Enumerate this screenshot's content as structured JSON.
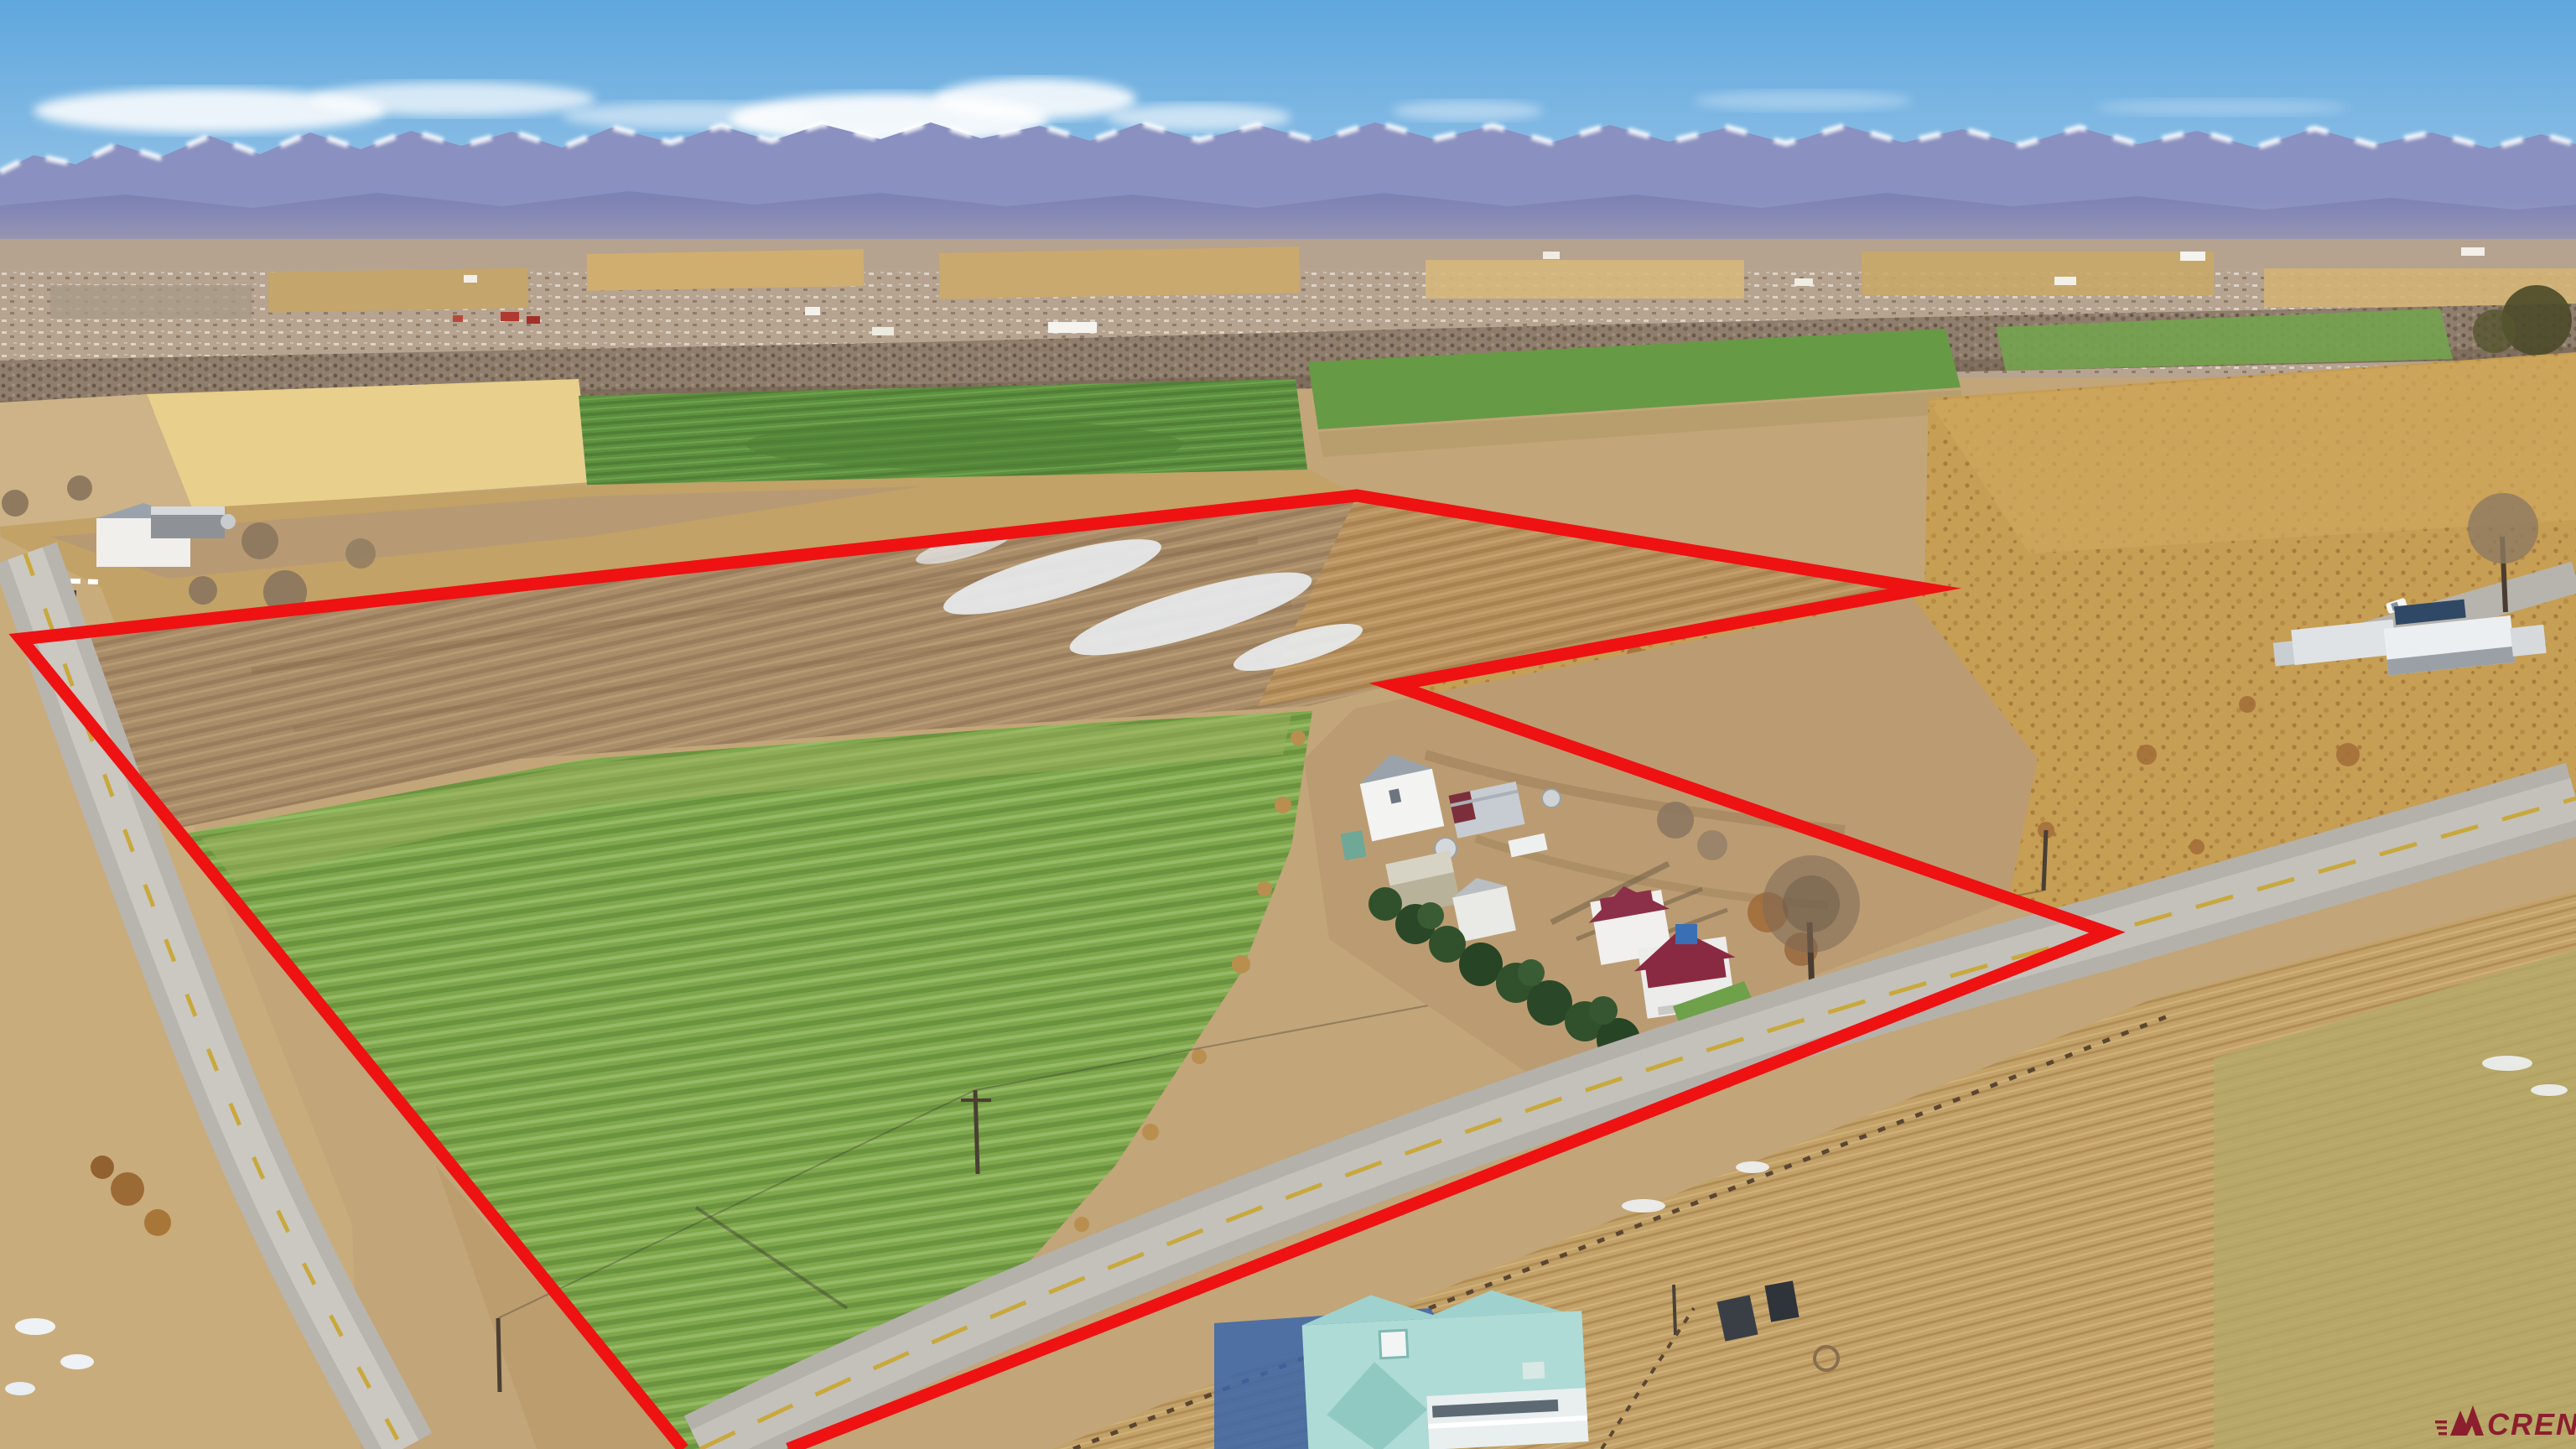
{
  "watermark": {
    "text": "CREN",
    "color": "#8c1e2e"
  },
  "annotation": {
    "boundary_points": "815,1728 25,762 1618,591 2295,702 1662,817 2513,1112 940,1728",
    "boundary_color": "#ee1212",
    "boundary_width": "15"
  },
  "palette": {
    "sky_top": "#5fa7dd",
    "sky_horizon": "#b6d5ec",
    "mountains": "#8a90bf",
    "mountain_snow": "#ffffff",
    "desert_mesa": "#b5a28f",
    "tree_band": "#8f7e6d",
    "wheat_field": "#e8cf8b",
    "distant_green": "#5d9140",
    "plowed_field": "#a98c68",
    "pasture_green": "#7fa84d",
    "scrub_gold": "#c69e54",
    "road_gray": "#b8b5af",
    "teal_roof": "#aedbd6",
    "maroon_roof": "#8a2a42"
  }
}
